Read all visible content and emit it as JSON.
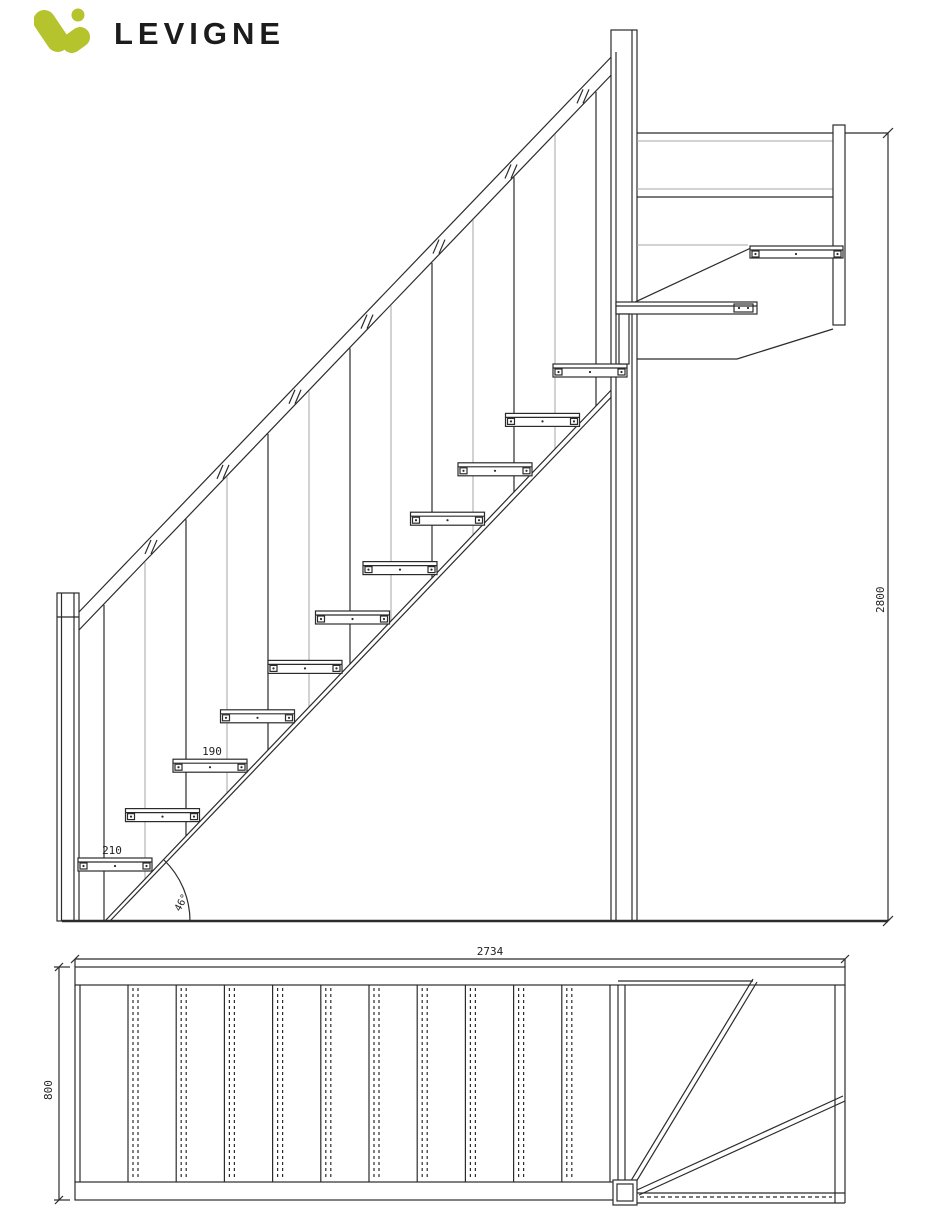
{
  "header": {
    "brand": "LEVIGNE"
  },
  "colors": {
    "logo_green": "#b5c32d",
    "logo_text": "#1c1c1c",
    "line_dark": "#2b2b2b",
    "line_light": "#a6a6a6"
  },
  "elevation": {
    "labels": {
      "total_rise": "2800",
      "bottom_going": "210",
      "mid_going": "190",
      "slope_angle": "46°"
    },
    "tread_count": 11,
    "baluster_count": 13,
    "rail_tick_count": 7
  },
  "plan": {
    "labels": {
      "total_run": "2734",
      "flight_width": "800"
    },
    "tread_line_count": 11
  }
}
